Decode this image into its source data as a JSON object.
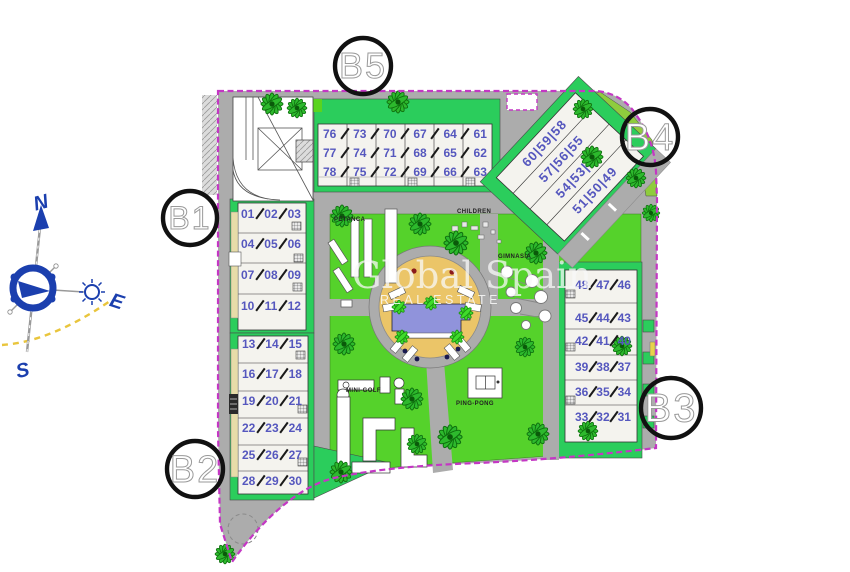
{
  "watermark": {
    "line1": "Global Spain",
    "line2": "REAL ESTATE"
  },
  "compass": {
    "north": "N",
    "south": "S",
    "east": "E"
  },
  "blocks": [
    "B1",
    "B2",
    "B3",
    "B4",
    "B5"
  ],
  "buildings": {
    "B5": [
      [
        "76",
        "73",
        "70",
        "67",
        "64",
        "61"
      ],
      [
        "77",
        "74",
        "71",
        "68",
        "65",
        "62"
      ],
      [
        "78",
        "75",
        "72",
        "69",
        "66",
        "63"
      ]
    ],
    "B1": [
      [
        "01",
        "02",
        "03"
      ],
      [
        "04",
        "05",
        "06"
      ],
      [
        "07",
        "08",
        "09"
      ],
      [
        "10",
        "11",
        "12"
      ]
    ],
    "B2": [
      [
        "13",
        "14",
        "15"
      ],
      [
        "16",
        "17",
        "18"
      ],
      [
        "19",
        "20",
        "21"
      ],
      [
        "22",
        "23",
        "24"
      ],
      [
        "25",
        "26",
        "27"
      ],
      [
        "28",
        "29",
        "30"
      ]
    ],
    "B3": [
      [
        "48",
        "47",
        "46"
      ],
      [
        "45",
        "44",
        "43"
      ],
      [
        "42",
        "41",
        "40"
      ],
      [
        "39",
        "38",
        "37"
      ],
      [
        "36",
        "35",
        "34"
      ],
      [
        "33",
        "32",
        "31"
      ]
    ],
    "B4": [
      [
        "60",
        "59",
        "58"
      ],
      [
        "57",
        "56",
        "55"
      ],
      [
        "54",
        "53",
        "52"
      ],
      [
        "51",
        "50",
        "49"
      ]
    ]
  },
  "amenities": [
    {
      "label": "PETANCA"
    },
    {
      "label": "CHILDREN"
    },
    {
      "label": "GIMNASIA"
    },
    {
      "label": "MINI-GOLF"
    },
    {
      "label": "PING-PONG"
    }
  ],
  "colors": {
    "lawn": "#55D22B",
    "garden": "#2BCD5C",
    "road": "#ACACAC",
    "boundary": "#C437C4",
    "deck": "#EBC568",
    "water": "#9093DB",
    "unit": "#5557BE",
    "compass": "#1B3FAE",
    "sunpath": "#E9C53C"
  }
}
